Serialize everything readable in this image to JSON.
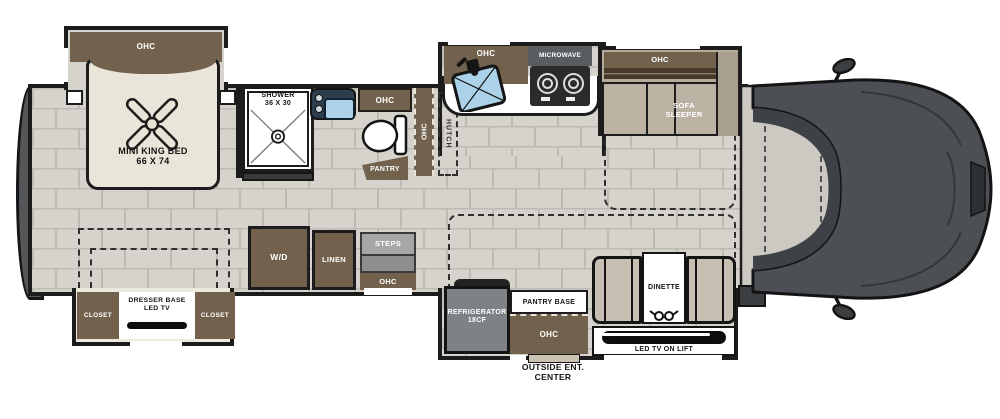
{
  "colors": {
    "cabinet_brown": "#72614c",
    "cabinet_dark_stripe": "#473a2b",
    "bed_cream": "#eae5d9",
    "floor_tile": "#d5d3cc",
    "tile_grout": "#bdbbb4",
    "wall_black": "#1c1c1c",
    "vanity_navy": "#2e3d4d",
    "sink_blue": "#abd2e9",
    "appliance_gray": "#7e8285",
    "steps_gray": "#a6a6a6",
    "upholstery_taupe": "#c7bfb1",
    "sofa_taupe": "#b4ab9d",
    "cab_body_gray": "#4c4f53",
    "cab_floor_gray": "#ccc9c3",
    "rear_cap_gray": "#54575a"
  },
  "labels": {
    "bedroom_ohc": "OHC",
    "bed_name": "MINI KING BED",
    "bed_size": "66 X 74",
    "shower_name": "SHOWER",
    "shower_size": "36 X 30",
    "bath_ohc": "OHC",
    "pantry": "PANTRY",
    "hall_ohc": "OHC",
    "hutch": "HUTCH",
    "kitchen_ohc": "OHC",
    "microwave": "MICROWAVE",
    "sofa_ohc": "OHC",
    "sofa_line1": "SOFA",
    "sofa_line2": "SLEEPER",
    "closet_left": "CLOSET",
    "closet_right": "CLOSET",
    "dresser_line1": "DRESSER BASE",
    "dresser_line2": "LED TV",
    "washer_dryer": "W/D",
    "linen": "LINEN",
    "steps": "STEPS",
    "entry_ohc": "OHC",
    "refrigerator_line1": "REFRIGERATOR",
    "refrigerator_line2": "18CF",
    "pantry_base": "PANTRY BASE",
    "galley_ohc": "OHC",
    "dinette": "DINETTE",
    "tv_lift": "LED TV ON LIFT",
    "outside_line1": "OUTSIDE ENT.",
    "outside_line2": "CENTER"
  },
  "icons": {
    "ceiling_fan": "x-blade-fan",
    "shower_drain": "concentric-circles",
    "toilet": "bowl-and-tank",
    "bath_sink": "basin-with-knobs",
    "kitchen_sink": "tilted-basin-with-faucet",
    "cooktop_burners": "two-rings",
    "dinette_cups": "two-cup-holders",
    "tv": "black-bar",
    "side_mirror": "stalk-mirror"
  }
}
